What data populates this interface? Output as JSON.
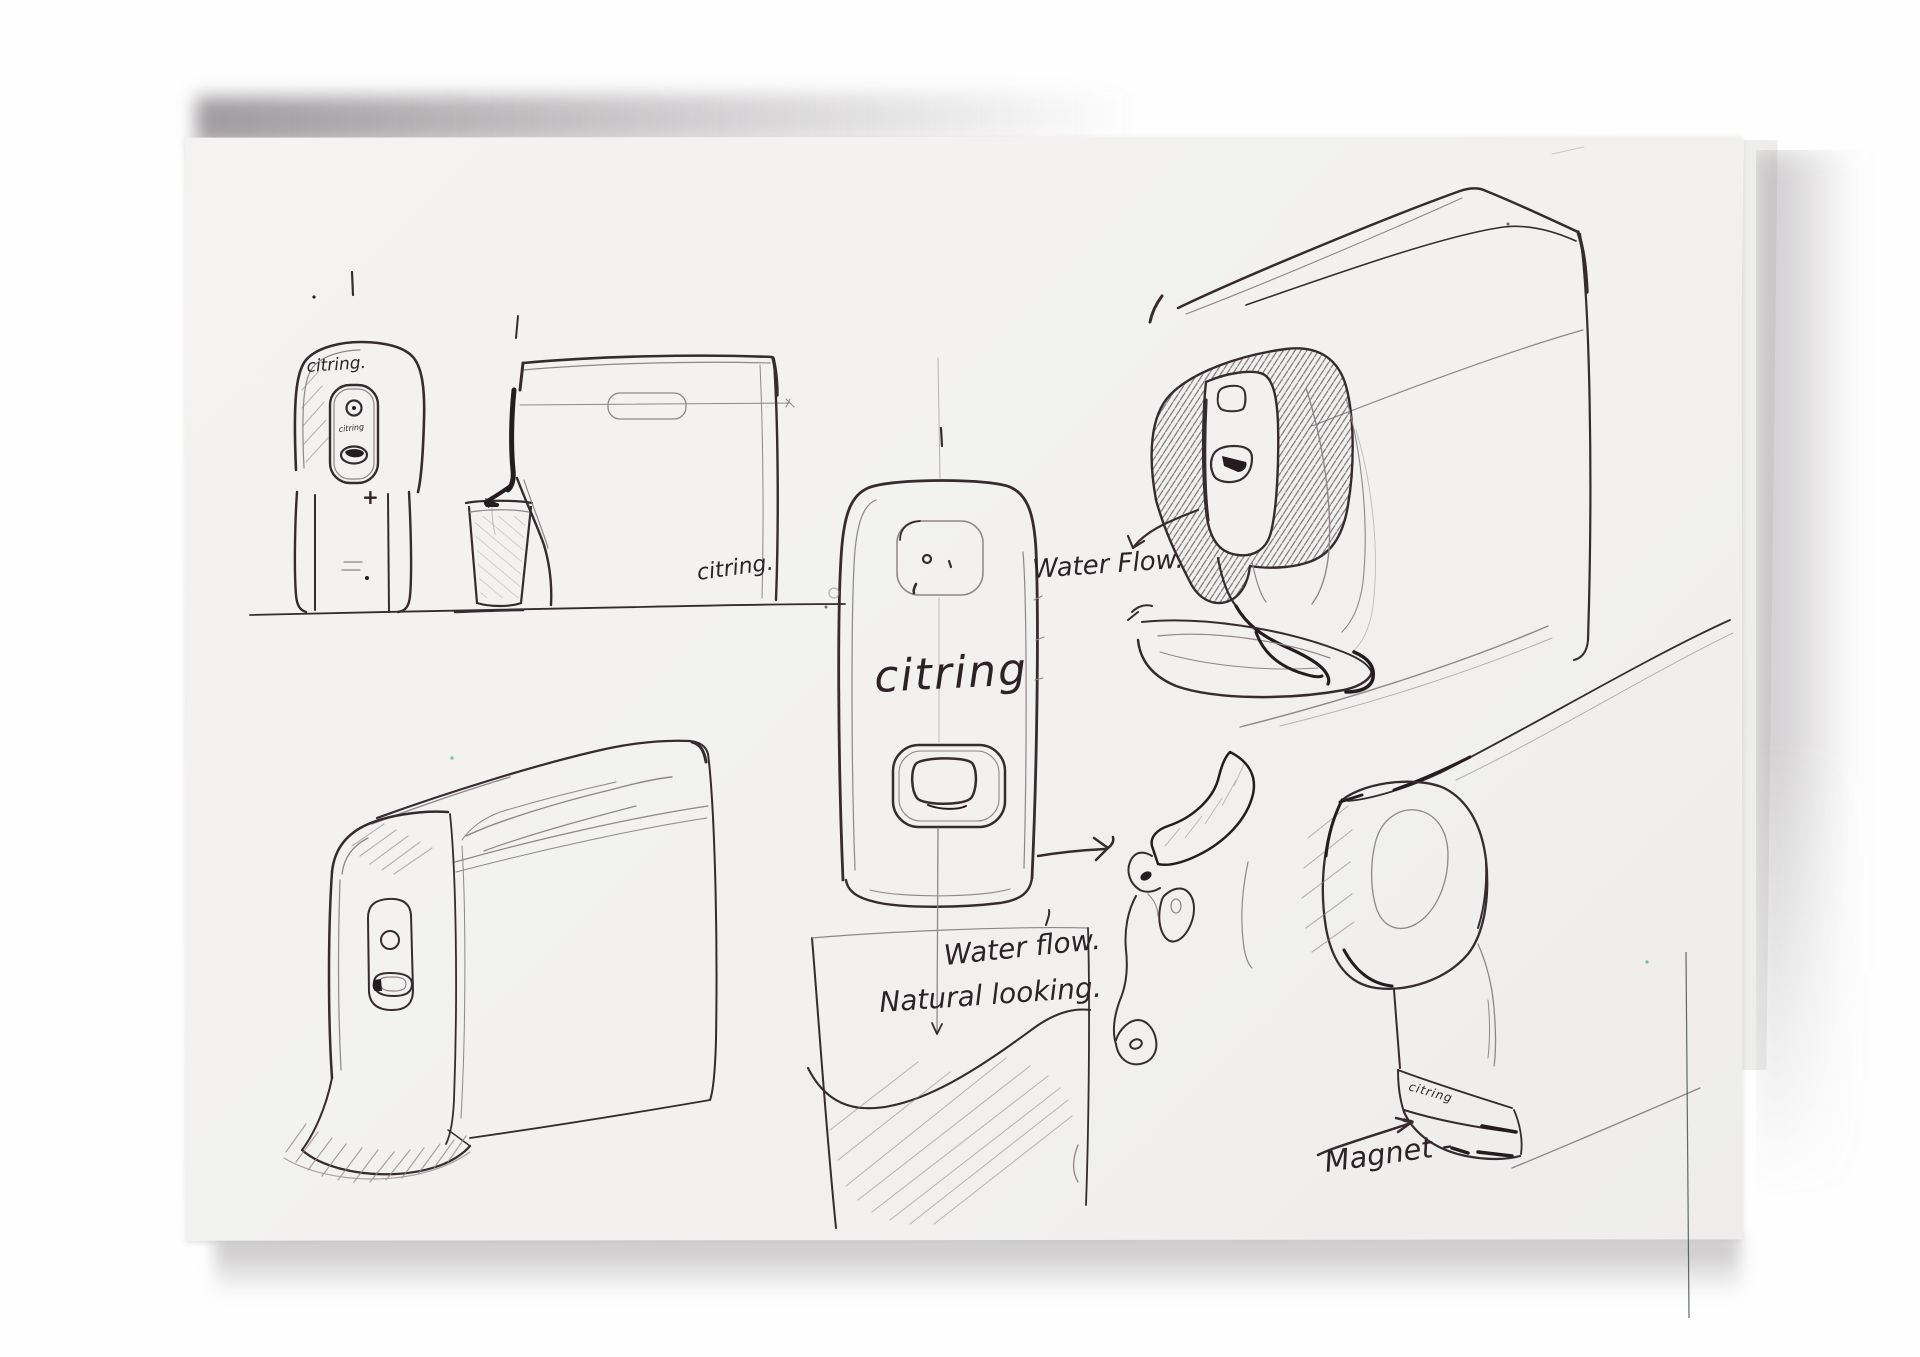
{
  "annotations": {
    "water_flow_top": "Water Flow.",
    "water_flow_center": "Water flow.",
    "natural_looking": "Natural looking.",
    "magnet": "Magnet -",
    "plus_mark": "+"
  },
  "branding": {
    "logo_front_small": "citring.",
    "logo_panel_tiny": "citring",
    "logo_side_box": "citring.",
    "logo_front_large": "citring",
    "logo_magnet_detail": "citring"
  },
  "colors": {
    "ink": "#352b31",
    "pencil": "#90858c",
    "paper": "#f2f1ef",
    "background": "#fefefe"
  }
}
